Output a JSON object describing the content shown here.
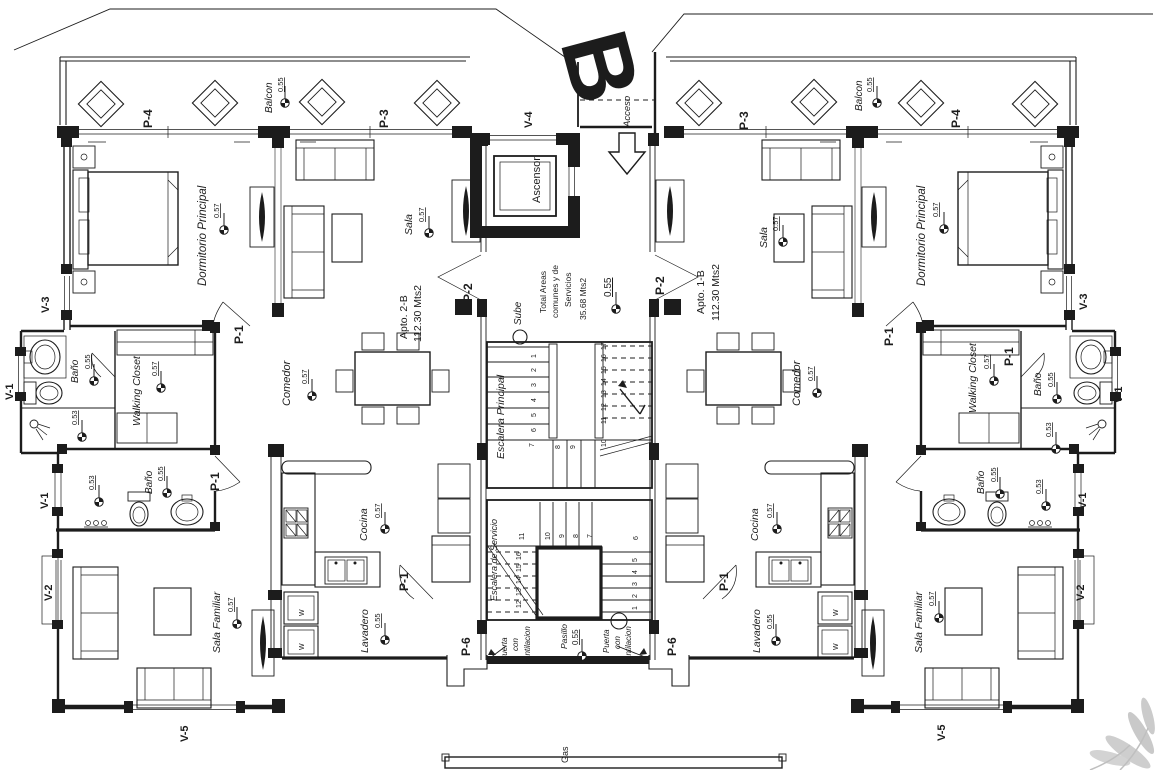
{
  "block_letter": "B",
  "core": {
    "acceso": "Acceso",
    "ascensor": "Ascensor",
    "sube": "Sube",
    "areas_line1": "Total Areas",
    "areas_line2": "comunes y de",
    "areas_line3": "Servicios",
    "areas_value": "35.68 Mts2",
    "core_level": "0.55",
    "escalera_principal": "Escalera Principal",
    "escalera_servicio": "Escalera de Servicio",
    "pasillo": "Pasillo",
    "pasillo_level": "0.55",
    "puerta_line1": "Puerta",
    "puerta_line2": "con",
    "puerta_line3": "ventilacion",
    "gas": "Gas"
  },
  "apartments": {
    "left": {
      "name": "Apto. 2-B",
      "area": "112.30 Mts2"
    },
    "right": {
      "name": "Apto. 1-B",
      "area": "112.30 Mts2"
    }
  },
  "rooms": {
    "dormitorio": "Dormitorio Principal",
    "sala": "Sala",
    "comedor": "Comedor",
    "cocina": "Cocina",
    "lavadero": "Lavadero",
    "bano": "Baño",
    "walking_closet": "Walking Closet",
    "sala_familiar": "Sala Familiar",
    "balcon": "Balcon",
    "washer": "W"
  },
  "levels": {
    "l53": "0.53",
    "l55": "0.55",
    "l57": "0.57"
  },
  "doors": {
    "p1": "P-1",
    "p2": "P-2",
    "p3": "P-3",
    "p4": "P-4",
    "p6": "P-6"
  },
  "windows": {
    "v1": "V-1",
    "v2": "V-2",
    "v3": "V-3",
    "v4": "V-4",
    "v5": "V-5"
  },
  "stairs": {
    "main": [
      "1",
      "2",
      "3",
      "4",
      "5",
      "6",
      "7",
      "8",
      "9",
      "10",
      "11",
      "12",
      "13",
      "14",
      "15",
      "16",
      "17"
    ],
    "service": [
      "1",
      "2",
      "3",
      "4",
      "5",
      "6",
      "7",
      "8",
      "9",
      "10",
      "11",
      "12",
      "13",
      "14",
      "15",
      "16"
    ]
  },
  "colors": {
    "letter_gray": "#8f8f8f",
    "palm_gray": "#c6c6c6",
    "line": "#1c1c1c"
  }
}
